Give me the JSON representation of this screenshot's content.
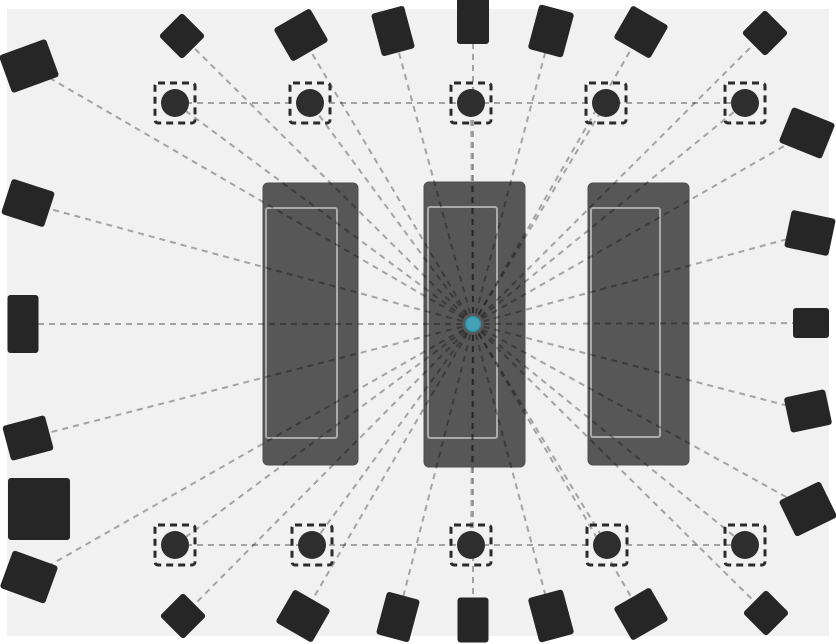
{
  "canvas": {
    "width": 836,
    "height": 644,
    "frame_color": "#ffffff",
    "floor": {
      "x": 7,
      "y": 9,
      "width": 822,
      "height": 627,
      "color": "#f1f1f2"
    }
  },
  "style": {
    "square_color": "#262626",
    "square_corner_radius": 3,
    "circle_color": "#2e2e2e",
    "circle_radius": 14,
    "circle_box_size": 40,
    "circle_box_border": "#2b2b2b",
    "circle_box_border_width": 3,
    "box_dash": "7 5",
    "wall_fill": "#575757",
    "wall_edge": "#4e4e4e",
    "wall_corner_radius": 5,
    "wall_inner_outline": "#aaaaaa",
    "wall_inner_outline_width": 2,
    "line_color": "rgba(0,0,0,0.32)",
    "line_width": 2,
    "line_dash": "6 5",
    "center_dot_fill": "#44a2b6",
    "center_dot_stroke": "#2f8ba0",
    "center_dot_radius": 7.5
  },
  "center": {
    "x": 473,
    "y": 324
  },
  "walls": [
    {
      "id": "wall-left",
      "x": 263,
      "y": 183,
      "width": 95,
      "height": 282,
      "inner": {
        "x": 266,
        "y": 208,
        "width": 71,
        "height": 230
      }
    },
    {
      "id": "wall-center",
      "x": 424,
      "y": 182,
      "width": 101,
      "height": 285,
      "inner": {
        "x": 428,
        "y": 207,
        "width": 69,
        "height": 231
      }
    },
    {
      "id": "wall-right",
      "x": 588,
      "y": 183,
      "width": 101,
      "height": 282,
      "inner": {
        "x": 591,
        "y": 208,
        "width": 69,
        "height": 229
      }
    }
  ],
  "squares": [
    {
      "cx": 29,
      "cy": 66,
      "w": 50,
      "h": 40,
      "rot": -20,
      "line": true
    },
    {
      "cx": 182,
      "cy": 36,
      "w": 33,
      "h": 33,
      "rot": 45,
      "line": true
    },
    {
      "cx": 301,
      "cy": 35,
      "w": 42,
      "h": 38,
      "rot": -30,
      "line": true
    },
    {
      "cx": 393,
      "cy": 31,
      "w": 34,
      "h": 44,
      "rot": -15,
      "line": true
    },
    {
      "cx": 473,
      "cy": 21,
      "w": 32,
      "h": 46,
      "rot": 0,
      "line": true
    },
    {
      "cx": 551,
      "cy": 31,
      "w": 36,
      "h": 46,
      "rot": 15,
      "line": true
    },
    {
      "cx": 641,
      "cy": 32,
      "w": 42,
      "h": 38,
      "rot": 30,
      "line": true
    },
    {
      "cx": 765,
      "cy": 33,
      "w": 33,
      "h": 33,
      "rot": 45,
      "line": true
    },
    {
      "cx": 807,
      "cy": 133,
      "w": 46,
      "h": 38,
      "rot": 22,
      "line": true
    },
    {
      "cx": 810,
      "cy": 233,
      "w": 45,
      "h": 38,
      "rot": 12,
      "line": true
    },
    {
      "cx": 811,
      "cy": 323,
      "w": 36,
      "h": 30,
      "rot": 0,
      "line": true
    },
    {
      "cx": 808,
      "cy": 411,
      "w": 42,
      "h": 36,
      "rot": -12,
      "line": true
    },
    {
      "cx": 808,
      "cy": 509,
      "w": 46,
      "h": 40,
      "rot": -26,
      "line": true
    },
    {
      "cx": 766,
      "cy": 613,
      "w": 33,
      "h": 33,
      "rot": 45,
      "line": true
    },
    {
      "cx": 641,
      "cy": 614,
      "w": 42,
      "h": 38,
      "rot": -30,
      "line": true
    },
    {
      "cx": 551,
      "cy": 616,
      "w": 36,
      "h": 46,
      "rot": -15,
      "line": true
    },
    {
      "cx": 473,
      "cy": 620,
      "w": 31,
      "h": 45,
      "rot": 0,
      "line": true
    },
    {
      "cx": 398,
      "cy": 617,
      "w": 34,
      "h": 44,
      "rot": 15,
      "line": true
    },
    {
      "cx": 303,
      "cy": 616,
      "w": 42,
      "h": 38,
      "rot": 30,
      "line": true
    },
    {
      "cx": 183,
      "cy": 616,
      "w": 33,
      "h": 33,
      "rot": 45,
      "line": true
    },
    {
      "cx": 29,
      "cy": 577,
      "w": 48,
      "h": 40,
      "rot": 20,
      "line": true
    },
    {
      "cx": 28,
      "cy": 203,
      "w": 45,
      "h": 37,
      "rot": 18,
      "line": true
    },
    {
      "cx": 23,
      "cy": 324,
      "w": 31,
      "h": 58,
      "rot": 0,
      "line": true
    },
    {
      "cx": 28,
      "cy": 438,
      "w": 44,
      "h": 36,
      "rot": -15,
      "line": true
    },
    {
      "cx": 39,
      "cy": 509,
      "w": 62,
      "h": 62,
      "rot": 0,
      "line": false
    }
  ],
  "circle_rows": [
    {
      "y": 103,
      "xs": [
        175,
        310,
        471,
        606,
        745
      ]
    },
    {
      "y": 545,
      "xs": [
        175,
        312,
        471,
        607,
        745
      ]
    }
  ],
  "row_lines": [
    {
      "y": 103,
      "x1": 175,
      "x2": 745
    },
    {
      "y": 545,
      "x1": 175,
      "x2": 745
    }
  ]
}
